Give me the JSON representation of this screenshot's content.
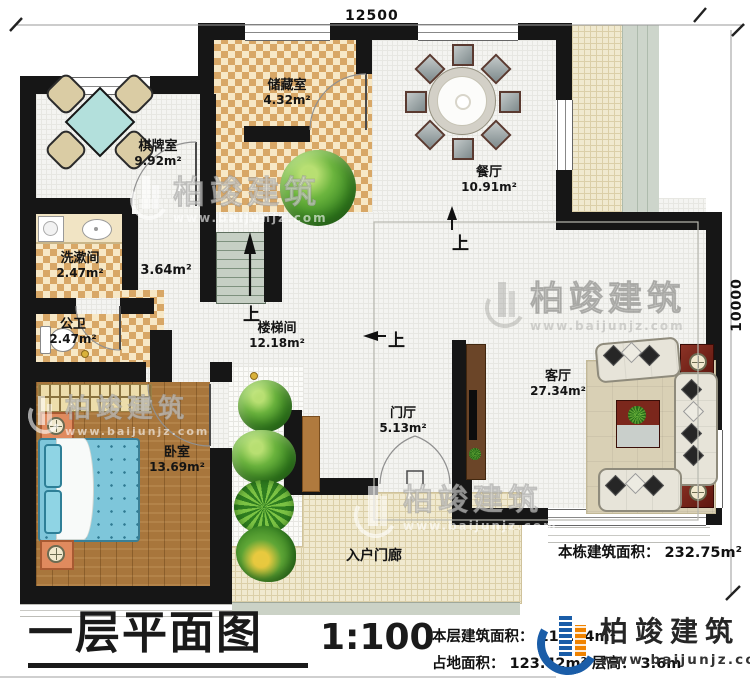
{
  "dimensions": {
    "top": "12500",
    "right": "10000"
  },
  "rooms": {
    "game": {
      "name": "棋牌室",
      "area": "9.92m²"
    },
    "storage": {
      "name": "储藏室",
      "area": "4.32m²"
    },
    "dining": {
      "name": "餐厅",
      "area": "10.91m²"
    },
    "washroom": {
      "name": "洗漱间",
      "area": "2.47m²"
    },
    "toilet": {
      "name": "公卫",
      "area": "2.47m²"
    },
    "hallway": {
      "area": "3.64m²"
    },
    "stairwell": {
      "name": "楼梯间",
      "area": "12.18m²"
    },
    "foyer": {
      "name": "门厅",
      "area": "5.13m²"
    },
    "living": {
      "name": "客厅",
      "area": "27.34m²"
    },
    "bedroom": {
      "name": "卧室",
      "area": "13.69m²"
    },
    "porch": {
      "name": "入户门廊"
    }
  },
  "annotations": {
    "up": "上",
    "building_total": "本栋建筑面积： 232.75m²"
  },
  "title_block": {
    "title": "一层平面图",
    "scale": "1:100",
    "line1": "本层建筑面积： 111.54m²",
    "line2": "占地面积： 123.42m²  层高： 3.6m"
  },
  "logo": {
    "brand": "柏竣建筑",
    "url": "www.baijunjz.com"
  },
  "watermark": {
    "brand": "柏竣建筑",
    "url": "www.baijunjz.com"
  },
  "colors": {
    "wall": "#161616",
    "checker_tan": "#D8A766",
    "wood": "#A8763C",
    "brand_blue": "#1A5DA8",
    "brand_orange": "#F08300"
  }
}
